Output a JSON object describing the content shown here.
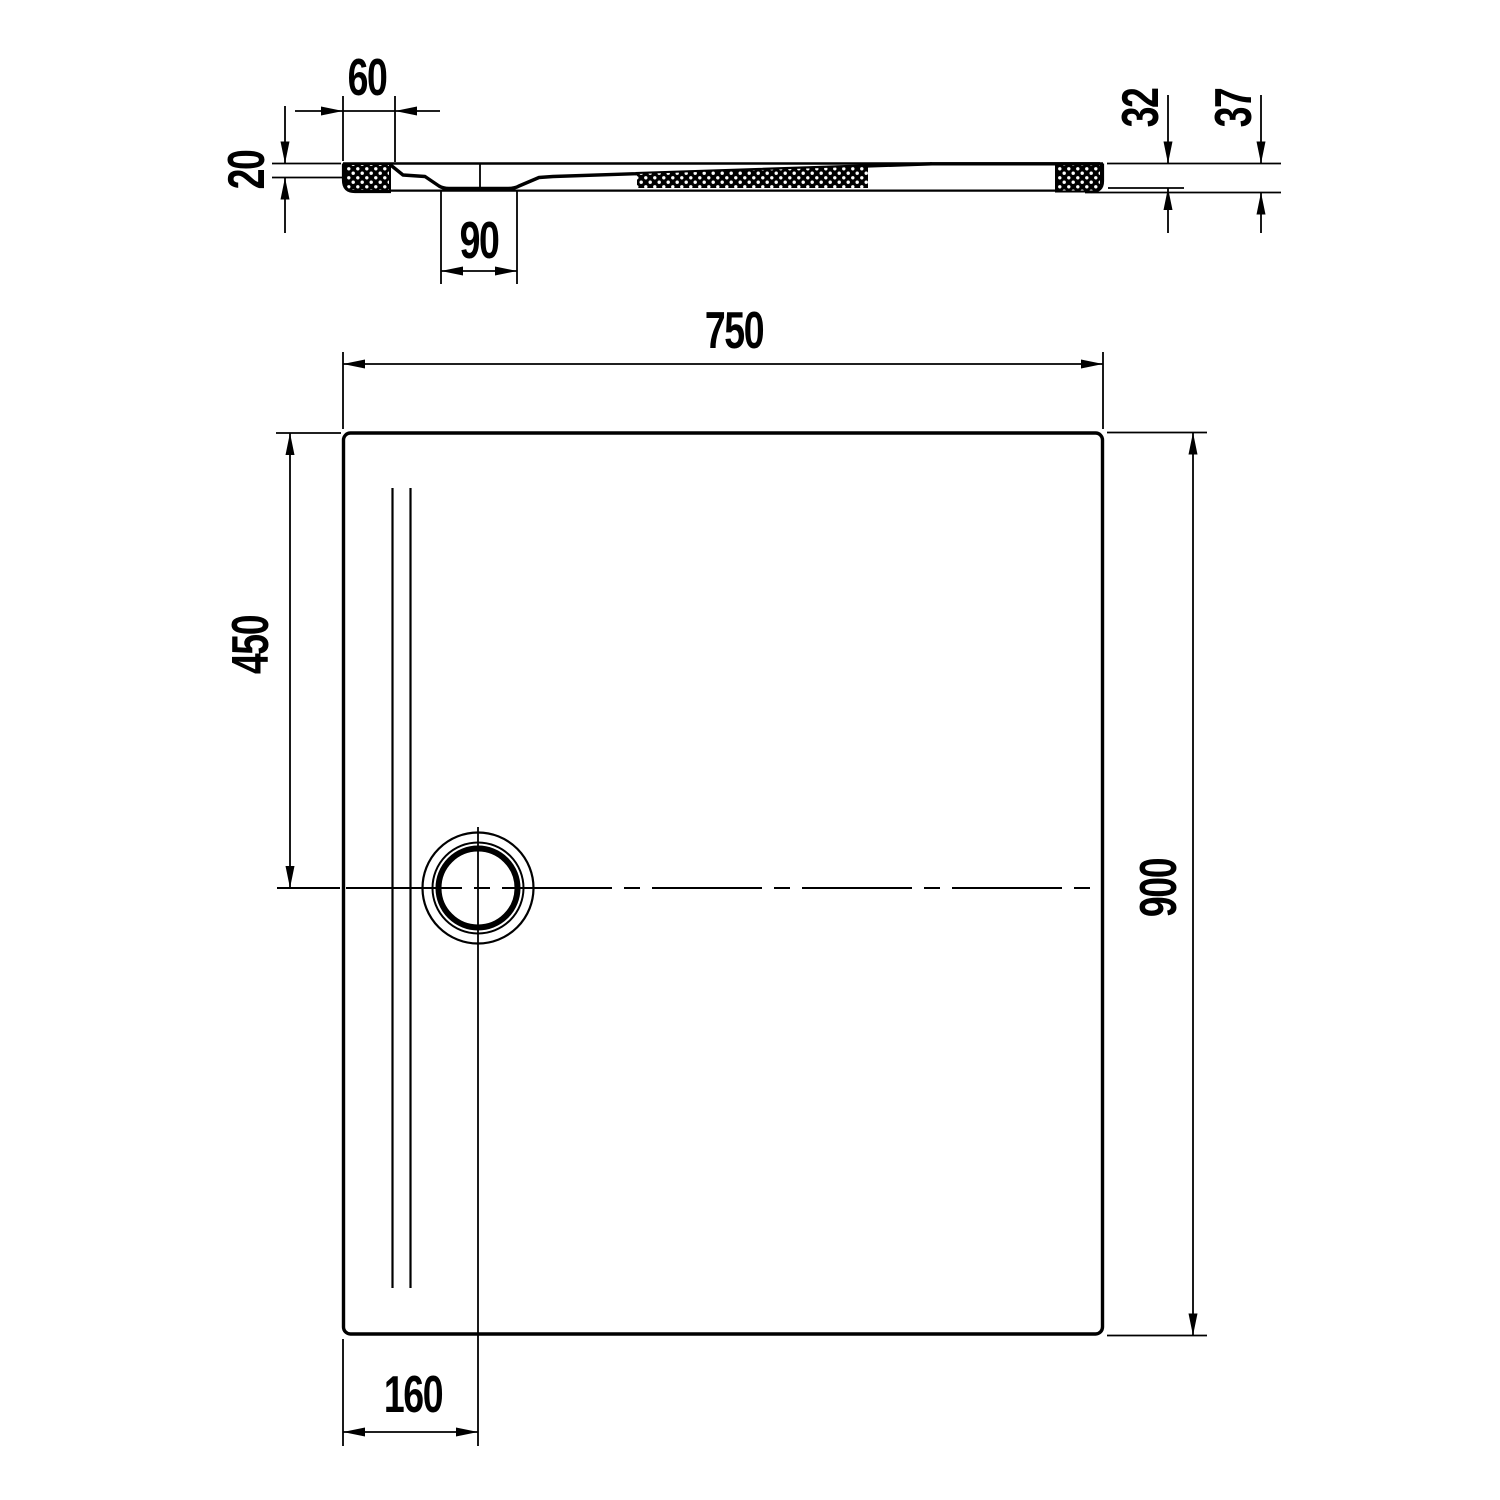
{
  "colors": {
    "background": "#ffffff",
    "line": "#000000"
  },
  "views": {
    "section": {
      "dimensions": {
        "rim_width": "60",
        "rim_thickness": "20",
        "outlet_recess_width": "90",
        "edge_height": "32",
        "total_height": "37"
      }
    },
    "plan": {
      "dimensions": {
        "width": "750",
        "drain_center_from_top": "450",
        "depth": "900",
        "drain_center_from_left": "160"
      }
    }
  }
}
